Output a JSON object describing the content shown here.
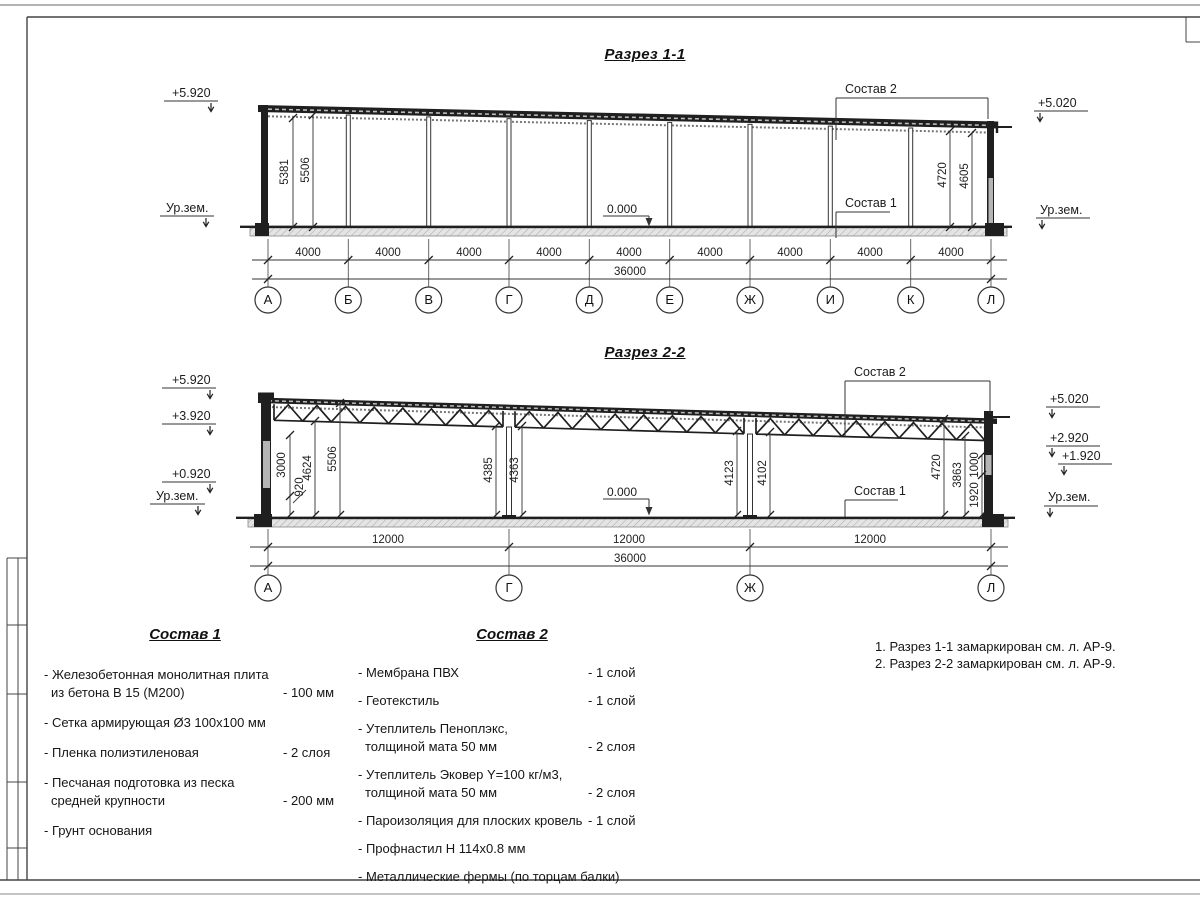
{
  "colors": {
    "line": "#2b2b2b",
    "fill_dark": "#1f1f1f",
    "fill_light": "#e0e0e0",
    "text": "#1c1c1c"
  },
  "s1": {
    "title": "Разрез 1-1",
    "elev": {
      "left_top": "+5.920",
      "left_ground": "Ур.зем.",
      "right_top": "+5.020",
      "right_ground": "Ур.зем."
    },
    "zero": "0.000",
    "leaders": {
      "top": "Состав 2",
      "bottom": "Состав 1"
    },
    "vdims": {
      "l1": "5381",
      "l2": "5506",
      "r1": "4720",
      "r2": "4605"
    },
    "span_dims": [
      "4000",
      "4000",
      "4000",
      "4000",
      "4000",
      "4000",
      "4000",
      "4000",
      "4000"
    ],
    "total": "36000",
    "axes": [
      "А",
      "Б",
      "В",
      "Г",
      "Д",
      "Е",
      "Ж",
      "И",
      "К",
      "Л"
    ]
  },
  "s2": {
    "title": "Разрез 2-2",
    "elev": {
      "l1": "+5.920",
      "l2": "+3.920",
      "l3": "+0.920",
      "l4": "Ур.зем.",
      "r1": "+5.020",
      "r2": "+2.920",
      "r3": "+1.920",
      "r4": "Ур.зем."
    },
    "zero": "0.000",
    "leaders": {
      "top": "Состав 2",
      "bottom": "Состав 1"
    },
    "vdims": {
      "a": "3000",
      "b": "920",
      "c": "4624",
      "d": "5506",
      "e": "4385",
      "f": "4363",
      "g": "4123",
      "h": "4102",
      "i": "4720",
      "j": "3863",
      "k": "1000",
      "l": "1920"
    },
    "span_dims": [
      "12000",
      "12000",
      "12000"
    ],
    "total": "36000",
    "axes": [
      "А",
      "Г",
      "Ж",
      "Л"
    ]
  },
  "legend1": {
    "title": "Состав 1",
    "items": [
      {
        "l1": "- Железобетонная  монолитная плита",
        "l2": "из бетона В 15 (М200)",
        "v": "- 100 мм"
      },
      {
        "l1": "- Сетка армирующая Ø3 100x100 мм",
        "l2": "",
        "v": ""
      },
      {
        "l1": "- Пленка полиэтиленовая",
        "l2": "",
        "v": "-  2 слоя"
      },
      {
        "l1": "- Песчаная подготовка из песка",
        "l2": "средней крупности",
        "v": "- 200 мм"
      },
      {
        "l1": "- Грунт основания",
        "l2": "",
        "v": ""
      }
    ]
  },
  "legend2": {
    "title": "Состав 2",
    "items": [
      {
        "l1": "- Мембрана ПВХ",
        "l2": "",
        "v": "- 1 слой"
      },
      {
        "l1": "- Геотекстиль",
        "l2": "",
        "v": "- 1 слой"
      },
      {
        "l1": "- Утеплитель Пеноплэкс,",
        "l2": "толщиной мата 50 мм",
        "v": "- 2 слоя"
      },
      {
        "l1": "- Утеплитель Эковер Y=100 кг/м3,",
        "l2": "толщиной мата 50 мм",
        "v": "- 2 слоя"
      },
      {
        "l1": "- Пароизоляция для плоских кровель",
        "l2": "",
        "v": "- 1 слой"
      },
      {
        "l1": "- Профнастил Н 114x0.8 мм",
        "l2": "",
        "v": ""
      },
      {
        "l1": "- Металлические фермы (по торцам балки)",
        "l2": "",
        "v": ""
      }
    ]
  },
  "notes": [
    "1. Разрез 1-1 замаркирован см. л. АР-9.",
    "2. Разрез 2-2 замаркирован см. л. АР-9."
  ]
}
